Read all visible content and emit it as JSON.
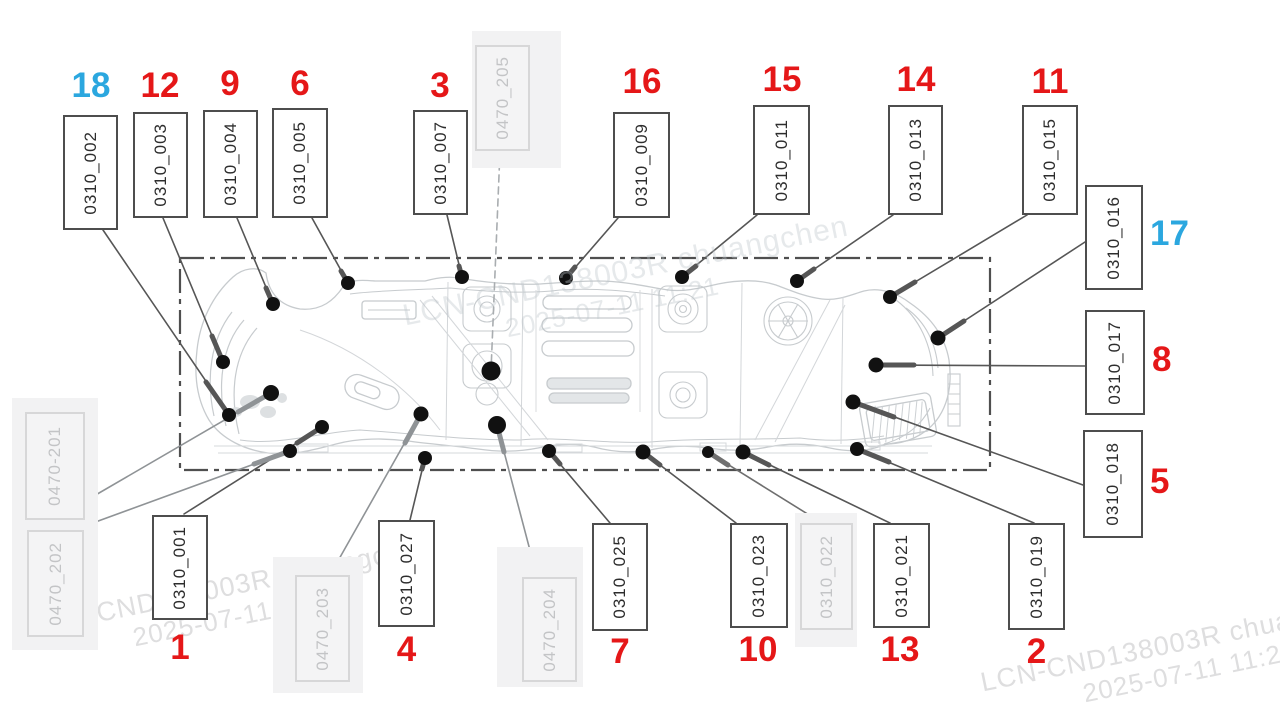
{
  "colors": {
    "red": "#e51718",
    "blue": "#2ba7df",
    "box_border": "#4d4d4d",
    "ghost_text": "#c3c4c6",
    "drawing_line": "#c7cbce",
    "leader_line": "#565656",
    "dot": "#111111"
  },
  "callouts": [
    {
      "number": "1",
      "code": "0310_001",
      "color": "red"
    },
    {
      "number": "2",
      "code": "0310_019",
      "color": "red"
    },
    {
      "number": "3",
      "code": "0310_007",
      "color": "red"
    },
    {
      "number": "4",
      "code": "0310_027",
      "color": "red"
    },
    {
      "number": "5",
      "code": "0310_018",
      "color": "red"
    },
    {
      "number": "6",
      "code": "0310_005",
      "color": "red"
    },
    {
      "number": "7",
      "code": "0310_025",
      "color": "red"
    },
    {
      "number": "8",
      "code": "0310_017",
      "color": "red"
    },
    {
      "number": "9",
      "code": "0310_004",
      "color": "red"
    },
    {
      "number": "10",
      "code": "0310_023",
      "color": "red"
    },
    {
      "number": "11",
      "code": "0310_015",
      "color": "red"
    },
    {
      "number": "12",
      "code": "0310_003",
      "color": "red"
    },
    {
      "number": "13",
      "code": "0310_021",
      "color": "red"
    },
    {
      "number": "14",
      "code": "0310_013",
      "color": "red"
    },
    {
      "number": "15",
      "code": "0310_011",
      "color": "red"
    },
    {
      "number": "16",
      "code": "0310_009",
      "color": "red"
    },
    {
      "number": "17",
      "code": "0310_016",
      "color": "blue"
    },
    {
      "number": "18",
      "code": "0310_002",
      "color": "blue"
    }
  ],
  "ghost_callouts": [
    {
      "code": "0470-201"
    },
    {
      "code": "0470_202"
    },
    {
      "code": "0470_203"
    },
    {
      "code": "0470_204"
    },
    {
      "code": "0470_205"
    },
    {
      "code": "0310_022"
    }
  ],
  "watermark": {
    "id_text": "LCN-CND138003R chuangchen",
    "timestamp": "2025-07-11 11:21"
  }
}
